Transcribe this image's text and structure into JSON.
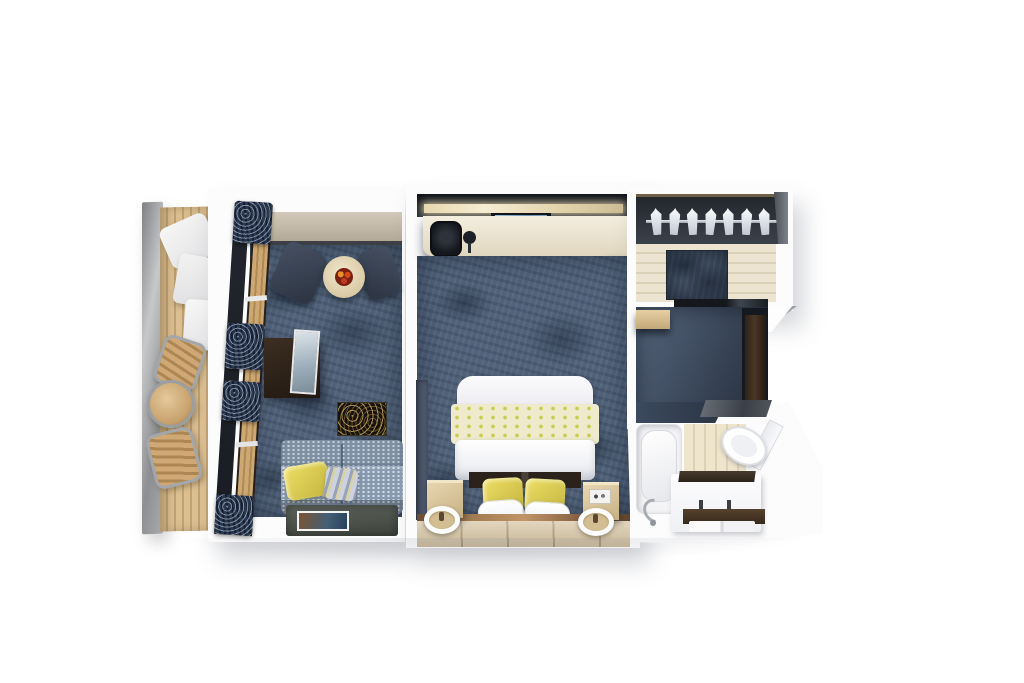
{
  "image": {
    "description": "3D top-down cutaway render of a suite floor plan with balcony, living room, bedroom, walk-in wardrobe, entry corridor and bathroom",
    "width_px": 1024,
    "height_px": 683,
    "background": "#ffffff",
    "visible_text": "none"
  },
  "palette": {
    "page_background": "#ffffff",
    "wall_white": "#fcfcfd",
    "carpet_blue": "#51627a",
    "carpet_dark": "#3c4a5e",
    "deck_wood": "#d8bb8a",
    "window_wood": "#c9a36d",
    "curtain_navy": "#2a3850",
    "desk_cream": "#efe7d6",
    "accent_yellow": "#e2d65c",
    "sofa_gray_blue": "#8293a6",
    "dark_walnut": "#34281f",
    "tile_beige": "#d6c5a4",
    "fixture_white": "#f6f6f8",
    "railing_steel": "#a9abad",
    "cove_light": "#f6ecd2"
  },
  "rooms": {
    "balcony": {
      "label": "Balcony",
      "items": [
        "steel railing",
        "teak deck",
        "stacked white loungers",
        "deck chair",
        "round table",
        "deck chair"
      ]
    },
    "living_room": {
      "label": "Living room",
      "items": [
        "window wall with navy curtains",
        "two armchairs",
        "round cocktail table with flowers",
        "TV sideboard",
        "wall art",
        "patterned sofa with yellow and striped pillows",
        "coffee table with magazine"
      ]
    },
    "bedroom": {
      "label": "Bedroom",
      "items": [
        "cove-lit headwall with TV",
        "desk with chair and lamp",
        "bed with yellow floral runner, yellow and white pillows",
        "two nightstands",
        "two round sconce lights",
        "bronze runner and tiled floor strip"
      ]
    },
    "wardrobe": {
      "label": "Walk-in wardrobe",
      "items": [
        "hanging rail with seven hangers",
        "light wood floor",
        "dark runner mat",
        "dark threshold"
      ]
    },
    "entry": {
      "label": "Entry corridor",
      "items": [
        "wall shelf",
        "dark entrance door"
      ]
    },
    "bathroom": {
      "label": "Bathroom",
      "items": [
        "bathtub with chrome faucet",
        "tiled splash wall",
        "vanity with dark counter and towel shelf",
        "toilet on angled wall"
      ]
    }
  }
}
